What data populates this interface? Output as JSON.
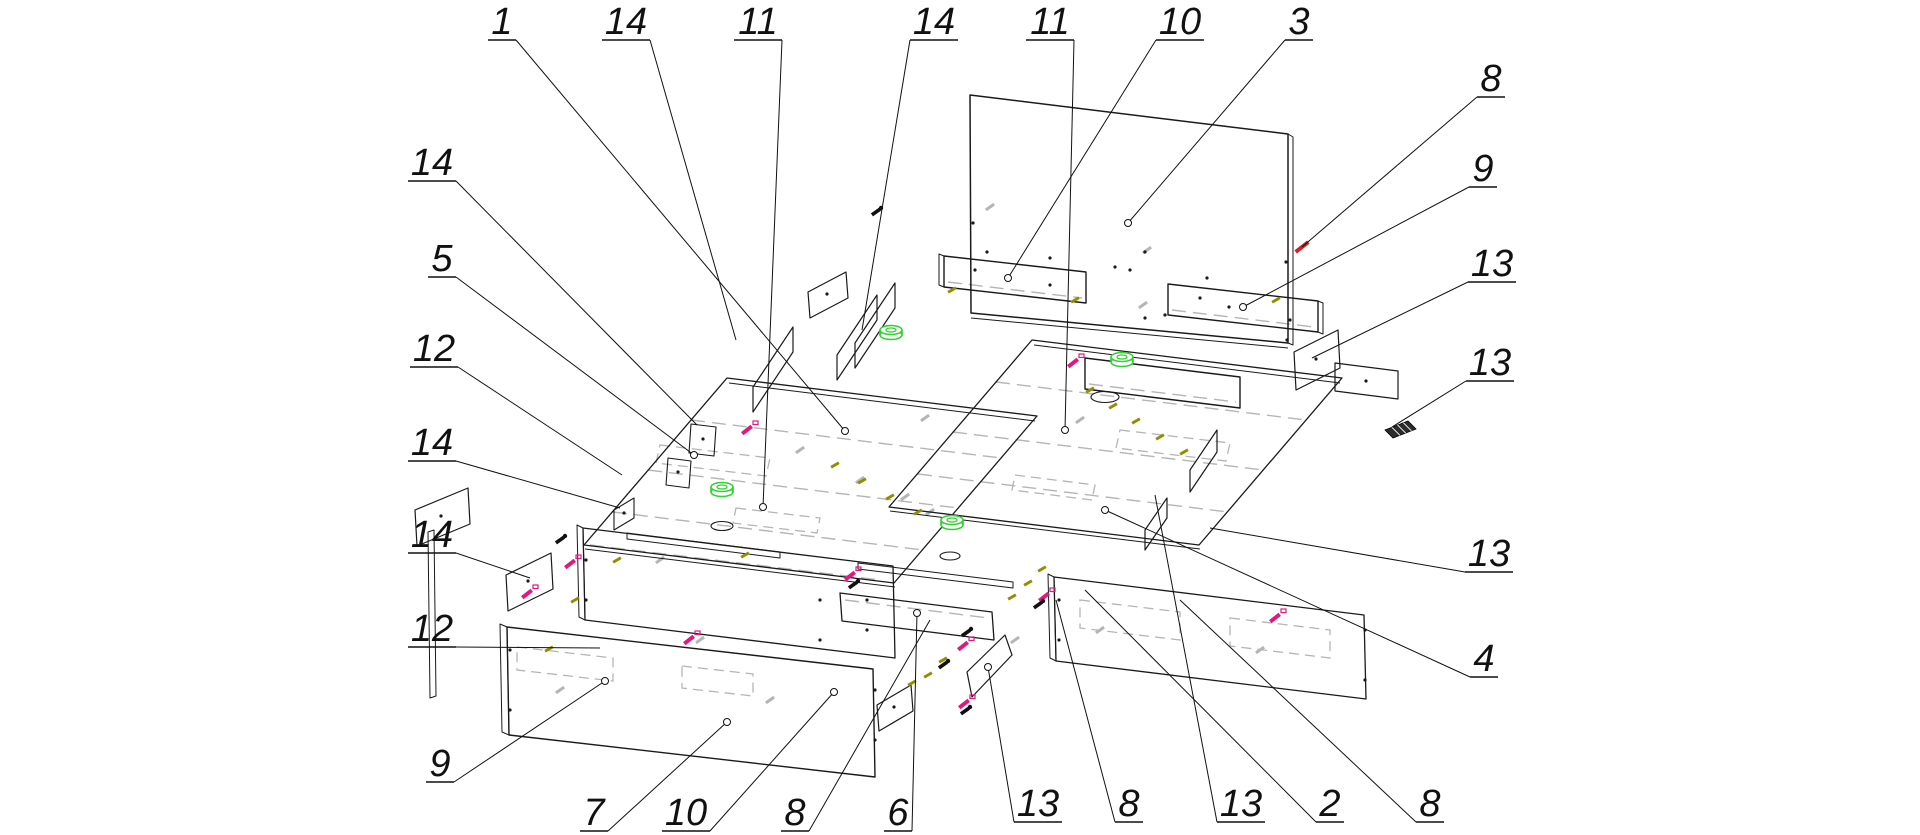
{
  "diagram": {
    "title": "exploded-furniture-assembly-drawing",
    "width": 1920,
    "height": 835,
    "background": "#ffffff",
    "colors": {
      "outline": "#1a1a1a",
      "hidden_gray": "#b5b5b5",
      "grommet_green": "#2ed32e",
      "screw_magenta": "#e2187d",
      "dowel_olive": "#8f8f00",
      "screw_red": "#d42020",
      "label_ink": "#111111"
    },
    "label_font_px": 38
  },
  "callouts": [
    {
      "t": "1",
      "x": 502,
      "y": 21,
      "tx": 845,
      "ty": 431,
      "dot": 1
    },
    {
      "t": "14",
      "x": 626,
      "y": 21,
      "tx": 736,
      "ty": 340,
      "dot": 0
    },
    {
      "t": "11",
      "x": 758,
      "y": 21,
      "tx": 763,
      "ty": 507,
      "dot": 1
    },
    {
      "t": "14",
      "x": 934,
      "y": 21,
      "tx": 862,
      "ty": 330,
      "dot": 0
    },
    {
      "t": "11",
      "x": 1050,
      "y": 21,
      "tx": 1065,
      "ty": 430,
      "dot": 1
    },
    {
      "t": "10",
      "x": 1180,
      "y": 21,
      "tx": 1008,
      "ty": 278,
      "dot": 1
    },
    {
      "t": "3",
      "x": 1299,
      "y": 21,
      "tx": 1128,
      "ty": 223,
      "dot": 1
    },
    {
      "t": "8",
      "x": 1491,
      "y": 78,
      "tx": 1302,
      "ty": 247,
      "dot": 0
    },
    {
      "t": "9",
      "x": 1483,
      "y": 168,
      "tx": 1243,
      "ty": 307,
      "dot": 1
    },
    {
      "t": "13",
      "x": 1492,
      "y": 263,
      "tx": 1312,
      "ty": 358,
      "dot": 0
    },
    {
      "t": "13",
      "x": 1490,
      "y": 362,
      "tx": 1392,
      "ty": 427,
      "dot": 0
    },
    {
      "t": "13",
      "x": 1489,
      "y": 553,
      "tx": 1210,
      "ty": 528,
      "dot": 0
    },
    {
      "t": "4",
      "x": 1484,
      "y": 658,
      "tx": 1105,
      "ty": 510,
      "dot": 1
    },
    {
      "t": "14",
      "x": 432,
      "y": 162,
      "tx": 697,
      "ty": 425,
      "dot": 0
    },
    {
      "t": "5",
      "x": 442,
      "y": 258,
      "tx": 694,
      "ty": 455,
      "dot": 1
    },
    {
      "t": "12",
      "x": 434,
      "y": 348,
      "tx": 622,
      "ty": 475,
      "dot": 0
    },
    {
      "t": "14",
      "x": 432,
      "y": 442,
      "tx": 620,
      "ty": 508,
      "dot": 0
    },
    {
      "t": "14",
      "x": 432,
      "y": 534,
      "tx": 530,
      "ty": 578,
      "dot": 0
    },
    {
      "t": "12",
      "x": 432,
      "y": 628,
      "tx": 600,
      "ty": 648,
      "dot": 0
    },
    {
      "t": "9",
      "x": 440,
      "y": 763,
      "tx": 605,
      "ty": 681,
      "dot": 1
    },
    {
      "t": "7",
      "x": 594,
      "y": 812,
      "tx": 727,
      "ty": 722,
      "dot": 1
    },
    {
      "t": "10",
      "x": 686,
      "y": 812,
      "tx": 834,
      "ty": 692,
      "dot": 1
    },
    {
      "t": "8",
      "x": 795,
      "y": 812,
      "tx": 930,
      "ty": 620,
      "dot": 0
    },
    {
      "t": "6",
      "x": 898,
      "y": 812,
      "tx": 917,
      "ty": 613,
      "dot": 1
    },
    {
      "t": "13",
      "x": 1038,
      "y": 803,
      "tx": 988,
      "ty": 667,
      "dot": 1
    },
    {
      "t": "8",
      "x": 1129,
      "y": 803,
      "tx": 1056,
      "ty": 600,
      "dot": 0
    },
    {
      "t": "13",
      "x": 1241,
      "y": 803,
      "tx": 1155,
      "ty": 495,
      "dot": 0
    },
    {
      "t": "2",
      "x": 1330,
      "y": 803,
      "tx": 1085,
      "ty": 590,
      "dot": 0
    },
    {
      "t": "8",
      "x": 1430,
      "y": 803,
      "tx": 1180,
      "ty": 600,
      "dot": 0
    }
  ],
  "panels": [
    {
      "n": "headboard",
      "pts": [
        [
          970,
          95
        ],
        [
          1288,
          134
        ],
        [
          1288,
          343
        ],
        [
          971,
          313
        ]
      ],
      "w": 1.5
    },
    {
      "n": "headboard-edge",
      "pts": [
        [
          1288,
          134
        ],
        [
          1293,
          137
        ],
        [
          1293,
          345
        ],
        [
          1288,
          343
        ]
      ],
      "w": 1
    },
    {
      "n": "rear-rail-left",
      "pts": [
        [
          944,
          256
        ],
        [
          1086,
          272
        ],
        [
          1086,
          303
        ],
        [
          944,
          287
        ]
      ],
      "w": 1.4
    },
    {
      "n": "rear-rail-left-cap",
      "pts": [
        [
          939,
          254
        ],
        [
          944,
          256
        ],
        [
          944,
          287
        ],
        [
          939,
          285
        ]
      ],
      "w": 1
    },
    {
      "n": "rear-rail-right",
      "pts": [
        [
          1168,
          284
        ],
        [
          1318,
          301
        ],
        [
          1318,
          332
        ],
        [
          1168,
          315
        ]
      ],
      "w": 1.4
    },
    {
      "n": "rear-rail-right-cap",
      "pts": [
        [
          1318,
          301
        ],
        [
          1323,
          303
        ],
        [
          1323,
          334
        ],
        [
          1318,
          332
        ]
      ],
      "w": 1
    },
    {
      "n": "platform-left",
      "pts": [
        [
          727,
          378
        ],
        [
          1037,
          416
        ],
        [
          894,
          583
        ],
        [
          584,
          545
        ]
      ],
      "w": 1.3
    },
    {
      "n": "platform-right",
      "pts": [
        [
          1032,
          340
        ],
        [
          1342,
          378
        ],
        [
          1199,
          545
        ],
        [
          889,
          507
        ]
      ],
      "w": 1.3
    },
    {
      "n": "rear-rail-right-box",
      "pts": [
        [
          1085,
          358
        ],
        [
          1240,
          377
        ],
        [
          1240,
          408
        ],
        [
          1085,
          389
        ]
      ],
      "w": 1.4
    },
    {
      "n": "side-rail-left",
      "pts": [
        [
          583,
          528
        ],
        [
          893,
          566
        ],
        [
          895,
          658
        ],
        [
          585,
          620
        ]
      ],
      "w": 1.3
    },
    {
      "n": "side-rail-left-cap",
      "pts": [
        [
          577,
          525
        ],
        [
          583,
          528
        ],
        [
          585,
          620
        ],
        [
          579,
          617
        ]
      ],
      "w": 1
    },
    {
      "n": "side-rail-right",
      "pts": [
        [
          1054,
          577
        ],
        [
          1364,
          615
        ],
        [
          1366,
          699
        ],
        [
          1056,
          661
        ]
      ],
      "w": 1.3
    },
    {
      "n": "side-rail-right-cap",
      "pts": [
        [
          1048,
          574
        ],
        [
          1054,
          577
        ],
        [
          1056,
          661
        ],
        [
          1050,
          658
        ]
      ],
      "w": 1
    },
    {
      "n": "center-rail",
      "pts": [
        [
          840,
          593
        ],
        [
          992,
          612
        ],
        [
          994,
          640
        ],
        [
          842,
          621
        ]
      ],
      "w": 1.3
    },
    {
      "n": "front-panel",
      "pts": [
        [
          507,
          627
        ],
        [
          873,
          669
        ],
        [
          875,
          777
        ],
        [
          509,
          735
        ]
      ],
      "w": 1.4
    },
    {
      "n": "front-panel-cap",
      "pts": [
        [
          500,
          624
        ],
        [
          507,
          627
        ],
        [
          509,
          735
        ],
        [
          502,
          732
        ]
      ],
      "w": 1
    },
    {
      "n": "front-strip-1",
      "pts": [
        [
          627,
          533
        ],
        [
          780,
          552
        ],
        [
          780,
          558
        ],
        [
          627,
          539
        ]
      ],
      "w": 1
    },
    {
      "n": "front-strip-2",
      "pts": [
        [
          858,
          563
        ],
        [
          1013,
          582
        ],
        [
          1013,
          588
        ],
        [
          858,
          569
        ]
      ],
      "w": 1
    },
    {
      "n": "side-edge-bar",
      "pts": [
        [
          428,
          532
        ],
        [
          434,
          530
        ],
        [
          436,
          696
        ],
        [
          430,
          698
        ]
      ],
      "w": 1
    },
    {
      "n": "partition-1",
      "pts": [
        [
          753,
          387
        ],
        [
          793,
          327
        ],
        [
          793,
          352
        ],
        [
          753,
          412
        ]
      ],
      "w": 1.2
    },
    {
      "n": "partition-2",
      "pts": [
        [
          837,
          355
        ],
        [
          877,
          295
        ],
        [
          877,
          320
        ],
        [
          837,
          380
        ]
      ],
      "w": 1.2
    },
    {
      "n": "partition-3",
      "pts": [
        [
          855,
          343
        ],
        [
          895,
          283
        ],
        [
          895,
          308
        ],
        [
          855,
          368
        ]
      ],
      "w": 1.2
    },
    {
      "n": "partition-4",
      "pts": [
        [
          1145,
          530
        ],
        [
          1167,
          498
        ],
        [
          1167,
          518
        ],
        [
          1145,
          550
        ]
      ],
      "w": 1.2
    },
    {
      "n": "partition-5",
      "pts": [
        [
          1190,
          470
        ],
        [
          1217,
          430
        ],
        [
          1217,
          452
        ],
        [
          1190,
          492
        ]
      ],
      "w": 1.2
    },
    {
      "n": "plate-a",
      "pts": [
        [
          415,
          510
        ],
        [
          468,
          488
        ],
        [
          470,
          524
        ],
        [
          417,
          546
        ]
      ],
      "w": 1.2
    },
    {
      "n": "plate-b",
      "pts": [
        [
          506,
          575
        ],
        [
          551,
          553
        ],
        [
          553,
          589
        ],
        [
          508,
          611
        ]
      ],
      "w": 1.2
    },
    {
      "n": "plate-c",
      "pts": [
        [
          614,
          510
        ],
        [
          634,
          498
        ],
        [
          634,
          518
        ],
        [
          614,
          530
        ]
      ],
      "w": 1.1
    },
    {
      "n": "plate-d",
      "pts": [
        [
          877,
          705
        ],
        [
          911,
          685
        ],
        [
          913,
          711
        ],
        [
          879,
          731
        ]
      ],
      "w": 1.2
    },
    {
      "n": "plate-p",
      "pts": [
        [
          967,
          672
        ],
        [
          1005,
          635
        ],
        [
          1012,
          655
        ],
        [
          972,
          697
        ]
      ],
      "w": 1.2
    },
    {
      "n": "plate-e",
      "pts": [
        [
          1294,
          352
        ],
        [
          1338,
          330
        ],
        [
          1340,
          368
        ],
        [
          1296,
          390
        ]
      ],
      "w": 1.2
    },
    {
      "n": "plate-f",
      "pts": [
        [
          1335,
          363
        ],
        [
          1398,
          371
        ],
        [
          1398,
          399
        ],
        [
          1335,
          391
        ]
      ],
      "w": 1.2
    },
    {
      "n": "plate-h",
      "pts": [
        [
          808,
          292
        ],
        [
          846,
          272
        ],
        [
          848,
          298
        ],
        [
          810,
          318
        ]
      ],
      "w": 1.2
    },
    {
      "n": "bracket-1",
      "pts": [
        [
          691,
          424
        ],
        [
          716,
          427
        ],
        [
          714,
          456
        ],
        [
          689,
          453
        ]
      ],
      "w": 1.1
    },
    {
      "n": "bracket-2",
      "pts": [
        [
          668,
          458
        ],
        [
          691,
          461
        ],
        [
          689,
          488
        ],
        [
          666,
          485
        ]
      ],
      "w": 1.1
    }
  ],
  "black_lines": [
    [
      971,
      318,
      1288,
      348,
      1
    ],
    [
      729,
      383,
      1035,
      421,
      1
    ],
    [
      585,
      549,
      895,
      587,
      1
    ],
    [
      1034,
      345,
      1340,
      383,
      1
    ],
    [
      890,
      511,
      1200,
      549,
      1
    ]
  ],
  "gray_dashed_lines": [
    [
      691,
      420,
      1001,
      458
    ],
    [
      648,
      470,
      958,
      508
    ],
    [
      613,
      512,
      923,
      550
    ],
    [
      996,
      382,
      1306,
      420
    ],
    [
      953,
      432,
      1263,
      470
    ],
    [
      918,
      474,
      1228,
      512
    ],
    [
      948,
      282,
      1082,
      298
    ],
    [
      1172,
      310,
      1314,
      327
    ],
    [
      590,
      545,
      880,
      580
    ],
    [
      845,
      600,
      988,
      618
    ],
    [
      1089,
      384,
      1236,
      402
    ]
  ],
  "gray_quads": [
    [
      [
        660,
        445
      ],
      [
        770,
        458
      ],
      [
        766,
        476
      ],
      [
        656,
        463
      ]
    ],
    [
      [
        736,
        508
      ],
      [
        820,
        518
      ],
      [
        817,
        533
      ],
      [
        733,
        523
      ]
    ],
    [
      [
        1120,
        430
      ],
      [
        1230,
        443
      ],
      [
        1226,
        461
      ],
      [
        1116,
        448
      ]
    ],
    [
      [
        1015,
        475
      ],
      [
        1095,
        485
      ],
      [
        1092,
        500
      ],
      [
        1012,
        490
      ]
    ],
    [
      [
        517,
        647
      ],
      [
        613,
        658
      ],
      [
        613,
        681
      ],
      [
        517,
        670
      ]
    ],
    [
      [
        682,
        666
      ],
      [
        753,
        674
      ],
      [
        753,
        696
      ],
      [
        682,
        688
      ]
    ],
    [
      [
        1080,
        600
      ],
      [
        1180,
        612
      ],
      [
        1180,
        640
      ],
      [
        1080,
        628
      ]
    ],
    [
      [
        1230,
        618
      ],
      [
        1330,
        630
      ],
      [
        1330,
        658
      ],
      [
        1230,
        646
      ]
    ]
  ],
  "holes": [
    {
      "cx": 722,
      "cy": 526,
      "rx": 11,
      "ry": 4.5
    },
    {
      "cx": 950,
      "cy": 556,
      "rx": 10,
      "ry": 4
    },
    {
      "cx": 1105,
      "cy": 397,
      "rx": 14,
      "ry": 5.5
    }
  ],
  "grommets": [
    [
      722,
      487
    ],
    [
      891,
      330
    ],
    [
      952,
      520
    ],
    [
      1122,
      357
    ]
  ],
  "magenta_screws": [
    [
      570,
      564
    ],
    [
      527,
      594
    ],
    [
      850,
      576
    ],
    [
      963,
      646
    ],
    [
      964,
      704
    ],
    [
      1044,
      597
    ],
    [
      689,
      640
    ],
    [
      747,
      430
    ],
    [
      1073,
      363
    ],
    [
      1275,
      618
    ]
  ],
  "black_keys": [
    [
      853,
      585
    ],
    [
      966,
      633
    ],
    [
      965,
      711
    ],
    [
      1038,
      605
    ],
    [
      560,
      540
    ],
    [
      943,
      665
    ],
    [
      876,
      212
    ]
  ],
  "olive_dowels": [
    [
      952,
      290
    ],
    [
      1075,
      300
    ],
    [
      617,
      560
    ],
    [
      575,
      600
    ],
    [
      549,
      649
    ],
    [
      1042,
      569
    ],
    [
      1028,
      583
    ],
    [
      1012,
      597
    ],
    [
      943,
      660
    ],
    [
      928,
      675
    ],
    [
      912,
      683
    ],
    [
      835,
      465
    ],
    [
      862,
      481
    ],
    [
      890,
      497
    ],
    [
      918,
      512
    ],
    [
      1090,
      390
    ],
    [
      1113,
      406
    ],
    [
      1136,
      421
    ],
    [
      1160,
      437
    ],
    [
      1184,
      452
    ],
    [
      745,
      555
    ],
    [
      1276,
      300
    ]
  ],
  "red_screws": [
    [
      1302,
      247
    ]
  ],
  "gray_screws": [
    [
      990,
      207
    ],
    [
      1147,
      250
    ],
    [
      1143,
      305
    ],
    [
      660,
      560
    ],
    [
      700,
      640
    ],
    [
      770,
      700
    ],
    [
      560,
      690
    ],
    [
      860,
      480
    ],
    [
      905,
      497
    ],
    [
      930,
      512
    ],
    [
      1080,
      420
    ],
    [
      1015,
      640
    ],
    [
      1100,
      630
    ],
    [
      1260,
      650
    ],
    [
      925,
      418
    ],
    [
      800,
      450
    ]
  ],
  "tiny_dots": [
    [
      973,
      223
    ],
    [
      987,
      252
    ],
    [
      1050,
      258
    ],
    [
      1130,
      270
    ],
    [
      1145,
      252
    ],
    [
      1115,
      267
    ],
    [
      1207,
      278
    ],
    [
      1145,
      318
    ],
    [
      1165,
      315
    ],
    [
      1229,
      307
    ],
    [
      1286,
      262
    ],
    [
      1287,
      340
    ],
    [
      975,
      270
    ],
    [
      1050,
      285
    ],
    [
      1200,
      298
    ],
    [
      1290,
      320
    ],
    [
      867,
      600
    ],
    [
      867,
      630
    ],
    [
      1059,
      600
    ],
    [
      1059,
      640
    ],
    [
      820,
      600
    ],
    [
      820,
      640
    ],
    [
      586,
      560
    ],
    [
      586,
      600
    ],
    [
      510,
      650
    ],
    [
      510,
      710
    ],
    [
      875,
      690
    ],
    [
      875,
      740
    ],
    [
      1365,
      630
    ],
    [
      1365,
      680
    ],
    [
      441,
      516
    ],
    [
      528,
      581
    ],
    [
      624,
      513
    ],
    [
      894,
      707
    ],
    [
      1316,
      359
    ],
    [
      1366,
      381
    ],
    [
      827,
      294
    ],
    [
      703,
      439
    ],
    [
      678,
      472
    ]
  ],
  "hatch_foot": {
    "pts": [
      [
        1385,
        430
      ],
      [
        1408,
        421
      ],
      [
        1416,
        429
      ],
      [
        1393,
        438
      ]
    ]
  }
}
